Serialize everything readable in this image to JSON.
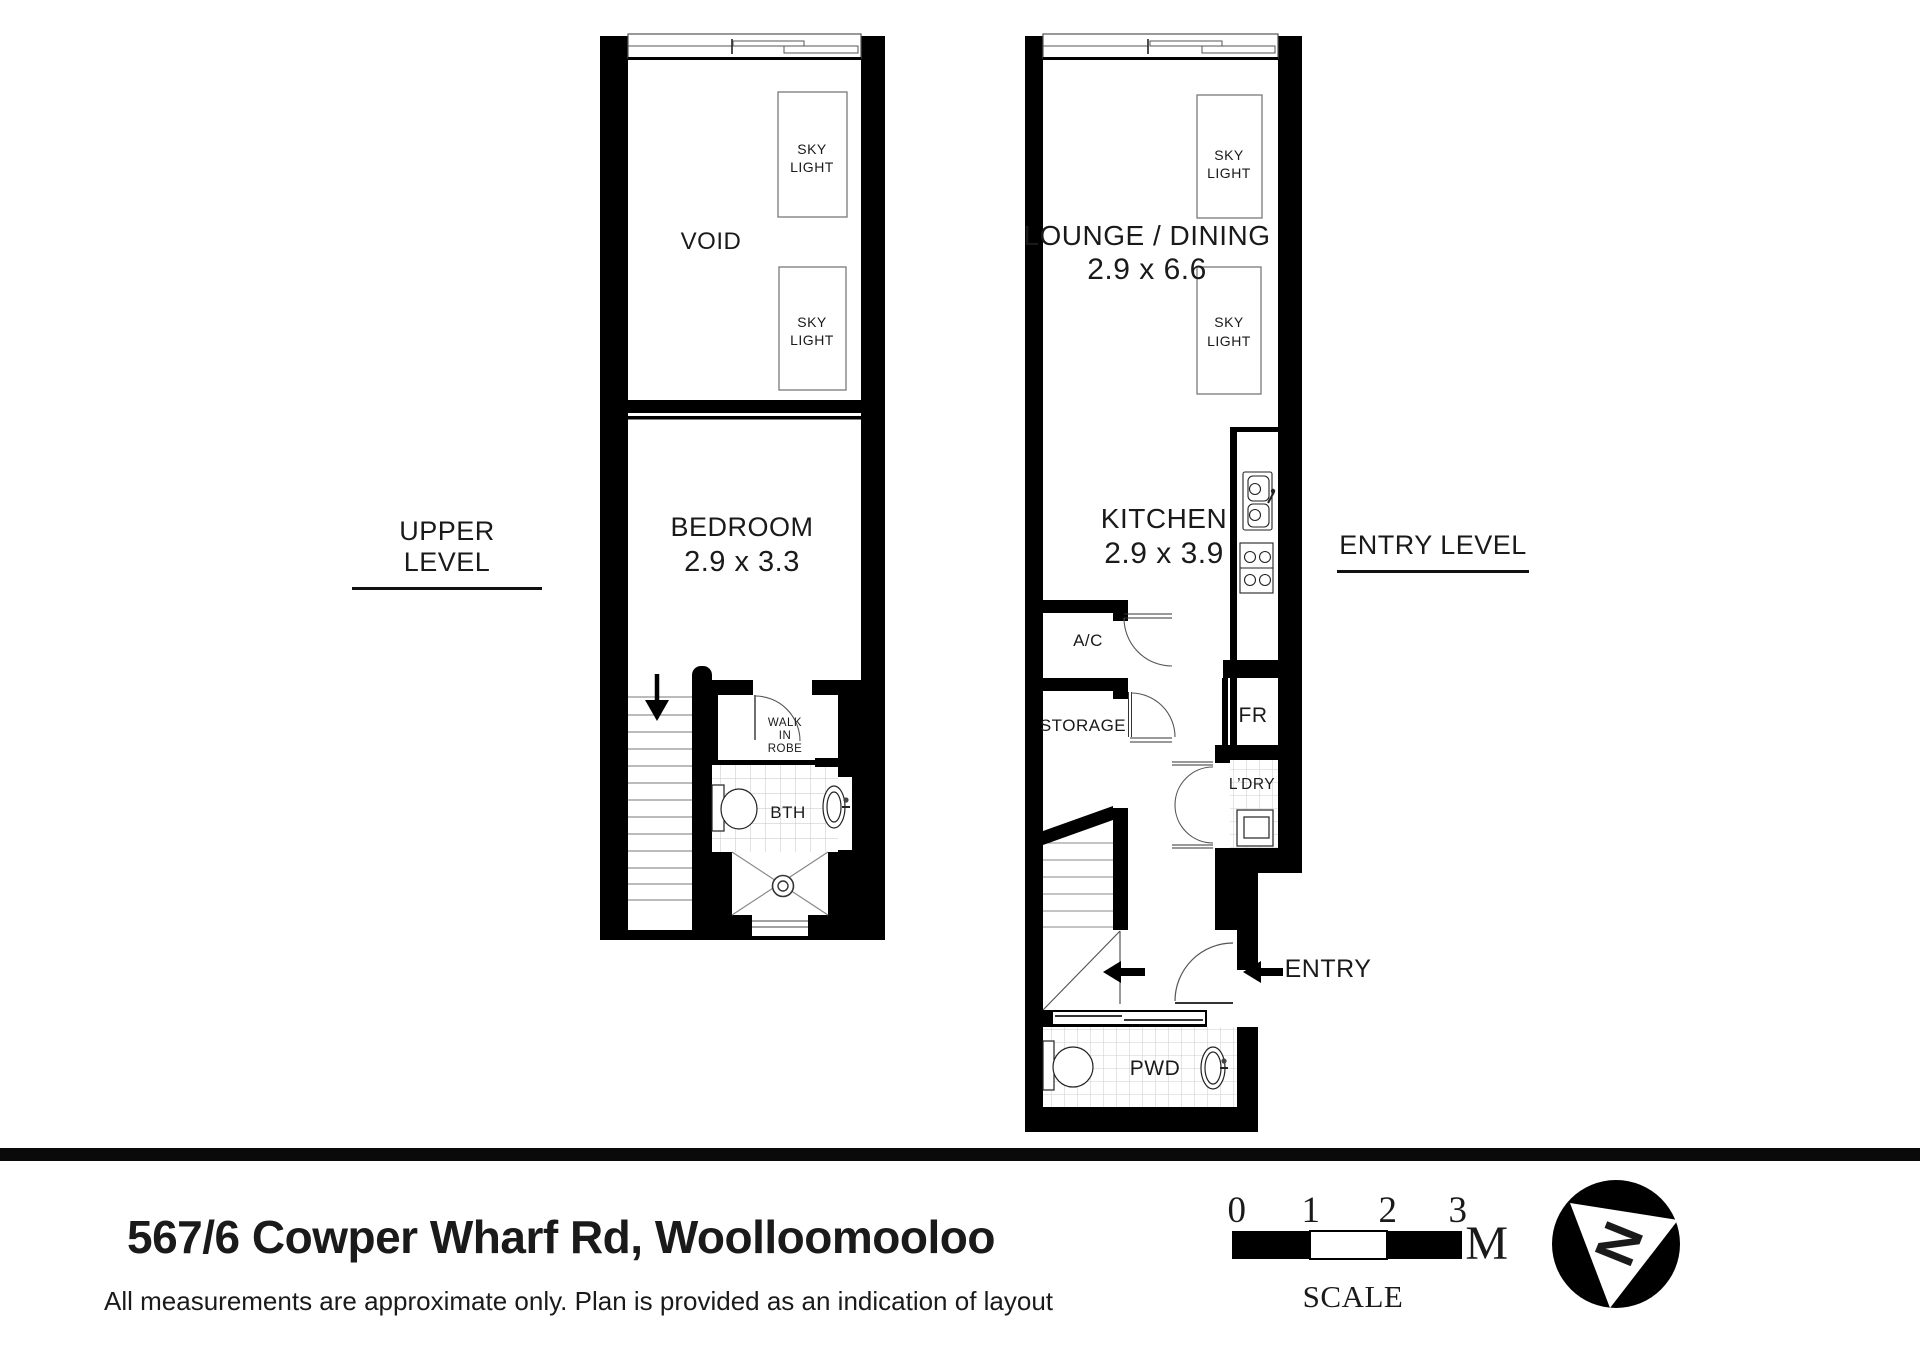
{
  "plans": {
    "upper": {
      "level_label": "UPPER LEVEL",
      "void_label": "VOID",
      "bedroom_label": "BEDROOM",
      "bedroom_dims": "2.9 x 3.3",
      "walk_in_robe_line1": "WALK",
      "walk_in_robe_line2": "IN",
      "walk_in_robe_line3": "ROBE",
      "bath_label": "BTH"
    },
    "entry": {
      "level_label": "ENTRY LEVEL",
      "lounge_label": "LOUNGE / DINING",
      "lounge_dims": "2.9 x 6.6",
      "kitchen_label": "KITCHEN",
      "kitchen_dims": "2.9 x 3.9",
      "ac_label": "A/C",
      "storage_label": "STORAGE",
      "fridge_label": "FR",
      "laundry_label": "L’DRY",
      "powder_label": "PWD",
      "entry_label": "ENTRY"
    }
  },
  "skylight": {
    "line1": "SKY",
    "line2": "LIGHT"
  },
  "footer": {
    "address": "567/6 Cowper Wharf Rd, Woolloomooloo",
    "disclaimer": "All measurements are approximate only. Plan is provided as an indication of layout",
    "scale": {
      "ticks": [
        "0",
        "1",
        "2",
        "3"
      ],
      "unit": "M",
      "label": "SCALE"
    },
    "north_letter": "N"
  },
  "colors": {
    "wall": "#000000",
    "tile_line": "#cfcfcf",
    "fixture_stroke": "#222222",
    "text": "#1a1a1a"
  }
}
